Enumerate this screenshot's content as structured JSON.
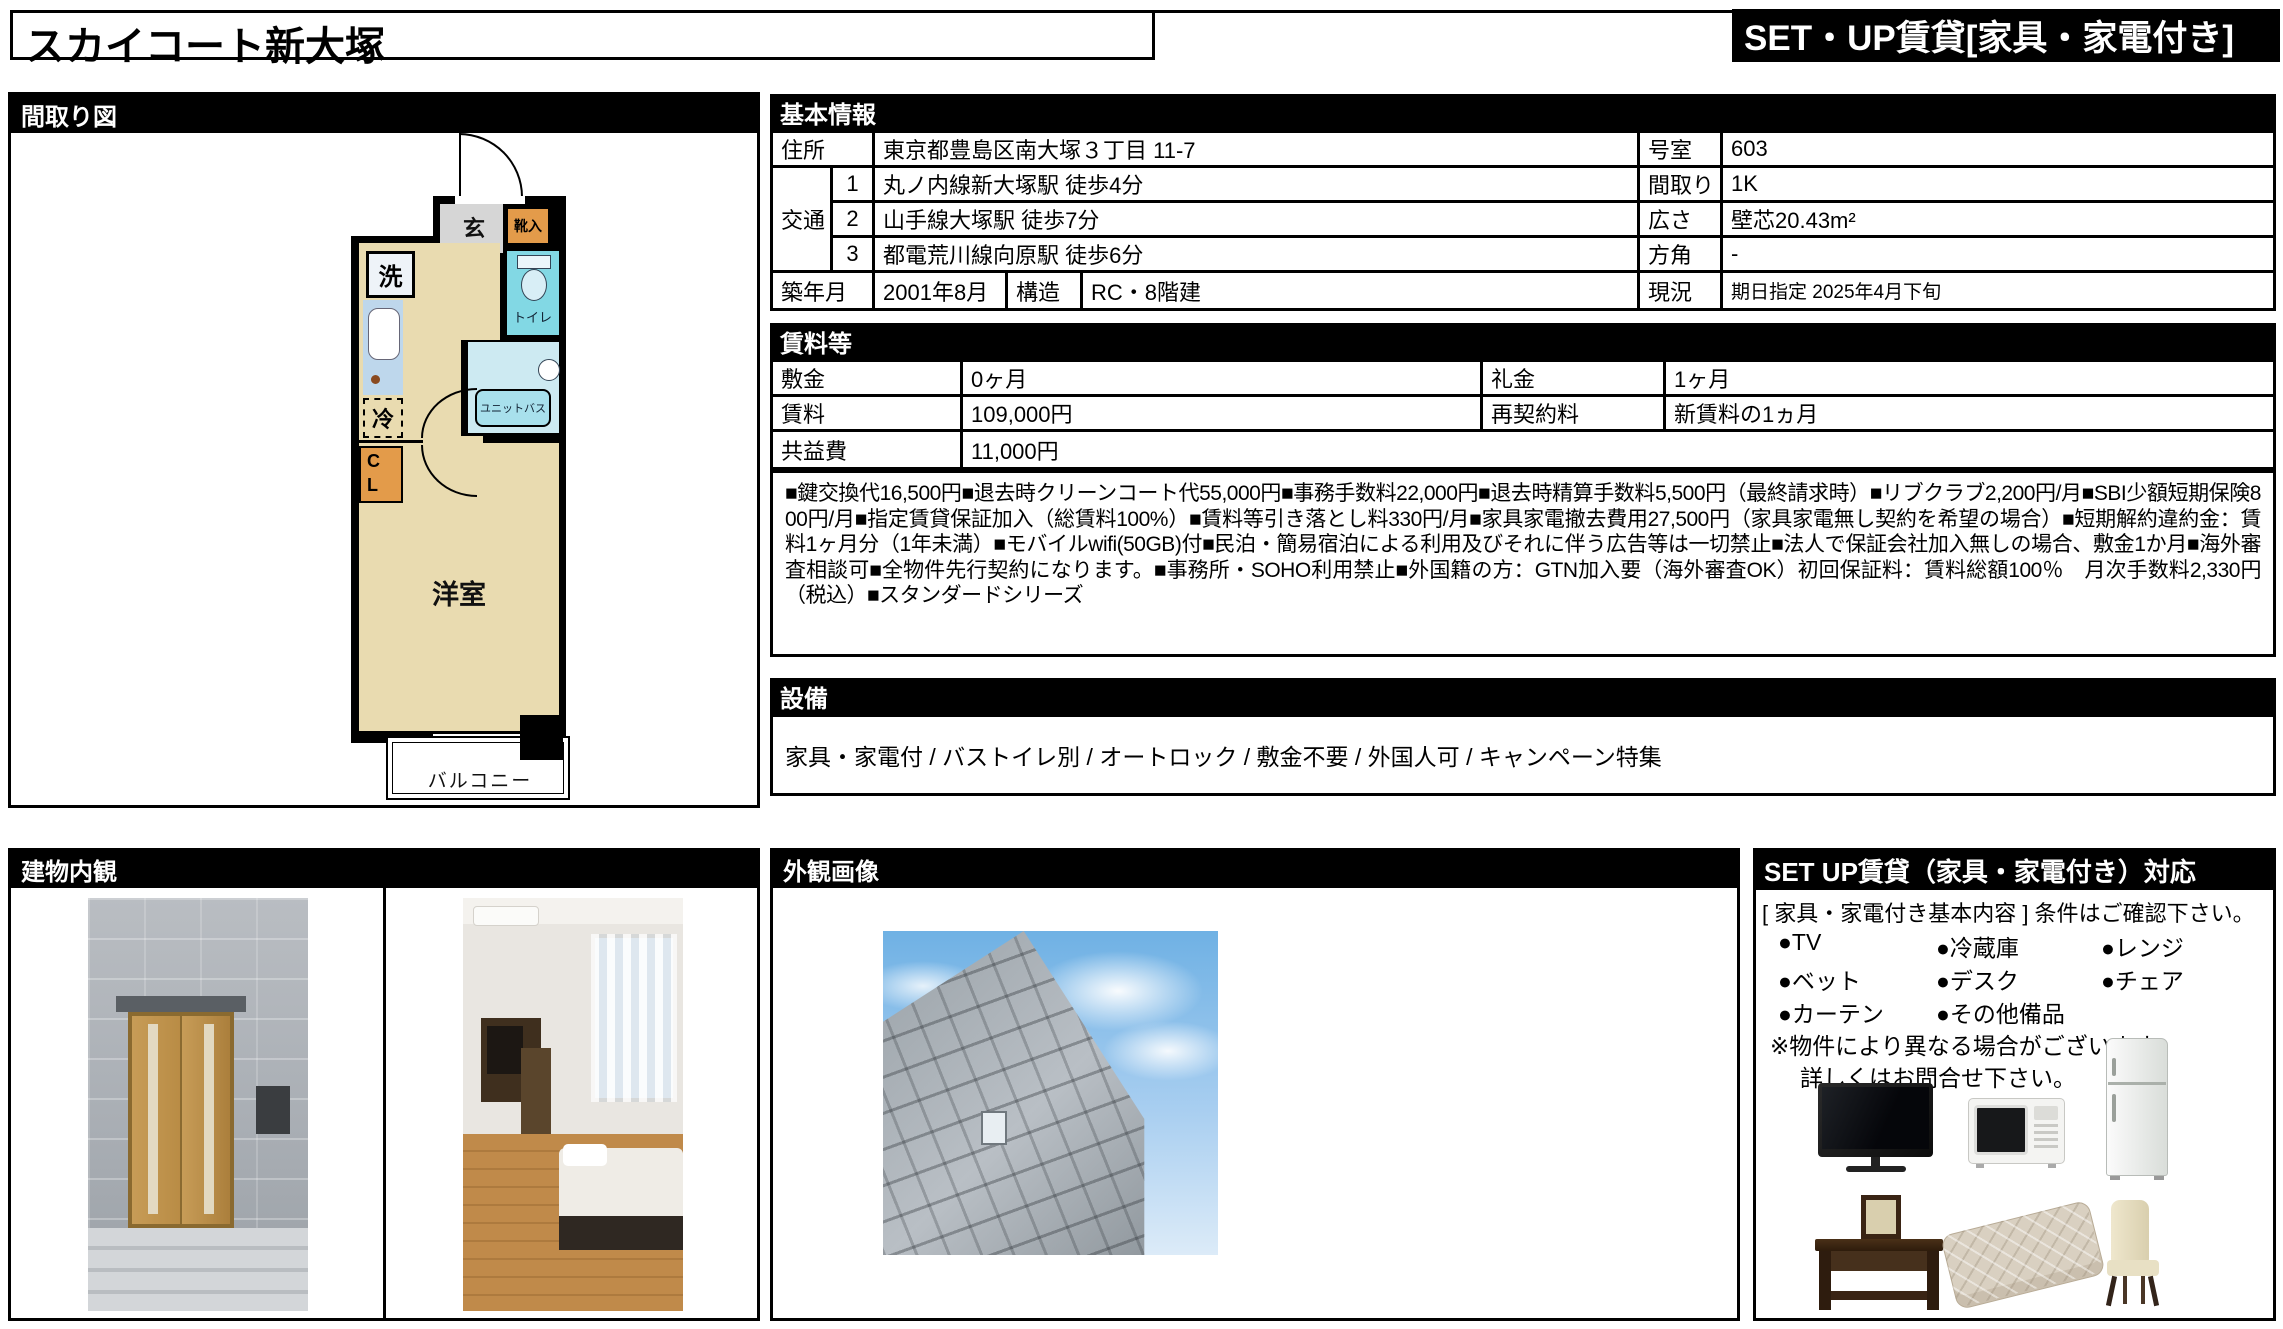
{
  "page": {
    "title": "スカイコート新大塚",
    "badge": "SET・UP賃貸[家具・家電付き]"
  },
  "floorplan": {
    "header": "間取り図",
    "rooms": {
      "genkan": "玄",
      "shoe_box": "靴入",
      "washer": "洗",
      "toilet": "トイレ",
      "unit_bath": "ユニットバス",
      "fridge": "冷",
      "closet_top": "C",
      "closet_bottom": "L",
      "western_room": "洋室",
      "balcony": "バルコニー"
    }
  },
  "basic_info": {
    "header": "基本情報",
    "address_label": "住所",
    "address": "東京都豊島区南大塚３丁目 11-7",
    "access_label": "交通",
    "access": [
      {
        "no": "1",
        "text": "丸ノ内線新大塚駅 徒歩4分"
      },
      {
        "no": "2",
        "text": "山手線大塚駅 徒歩7分"
      },
      {
        "no": "3",
        "text": "都電荒川線向原駅 徒歩6分"
      }
    ],
    "built_label": "築年月",
    "built": "2001年8月",
    "structure_label": "構造",
    "structure": "RC・8階建",
    "room_no_label": "号室",
    "room_no": "603",
    "layout_label": "間取り",
    "layout": "1K",
    "size_label": "広さ",
    "size": "壁芯20.43m²",
    "direction_label": "方角",
    "direction": "-",
    "status_label": "現況",
    "status": "期日指定 2025年4月下旬"
  },
  "rent": {
    "header": "賃料等",
    "deposit_label": "敷金",
    "deposit": "0ヶ月",
    "key_money_label": "礼金",
    "key_money": "1ヶ月",
    "rent_label": "賃料",
    "rent": "109,000円",
    "renewal_label": "再契約料",
    "renewal": "新賃料の1ヵ月",
    "common_fee_label": "共益費",
    "common_fee": "11,000円",
    "notes": "■鍵交換代16,500円■退去時クリーンコート代55,000円■事務手数料22,000円■退去時精算手数料5,500円（最終請求時）■リブクラブ2,200円/月■SBI少額短期保険800円/月■指定賃貸保証加入（総賃料100%）■賃料等引き落とし料330円/月■家具家電撤去費用27,500円（家具家電無し契約を希望の場合）■短期解約違約金：賃料1ヶ月分（1年未満）■モバイルwifi(50GB)付■民泊・簡易宿泊による利用及びそれに伴う広告等は一切禁止■法人で保証会社加入無しの場合、敷金1か月■海外審査相談可■全物件先行契約になります。■事務所・SOHO利用禁止■外国籍の方：GTN加入要（海外審査OK）初回保証料：賃料総額100％　月次手数料2,330円（税込）■スタンダードシリーズ"
  },
  "facilities": {
    "header": "設備",
    "text": "家具・家電付 / バストイレ別 / オートロック / 敷金不要 / 外国人可 / キャンペーン特集"
  },
  "interior": {
    "header": "建物内観"
  },
  "exterior": {
    "header": "外観画像"
  },
  "setup": {
    "header": "SET UP賃貸（家具・家電付き）対応",
    "subtitle": "[ 家具・家電付き基本内容 ] 条件はご確認下さい。",
    "items": [
      "●TV",
      "●冷蔵庫",
      "●レンジ",
      "●ベット",
      "●デスク",
      "●チェア",
      "●カーテン",
      "●その他備品"
    ],
    "note1": "※物件により異なる場合がございます。",
    "note2": "詳しくはお問合せ下さい。"
  },
  "colors": {
    "header_bg": "#000000",
    "floor_beige": "#e9dbb0",
    "water_cyan": "#82d8e4",
    "bath_light": "#cdeaf2",
    "counter_blue": "#bed7ec",
    "closet_orange": "#e39b4a",
    "genkan_gray": "#d6d6d6"
  }
}
